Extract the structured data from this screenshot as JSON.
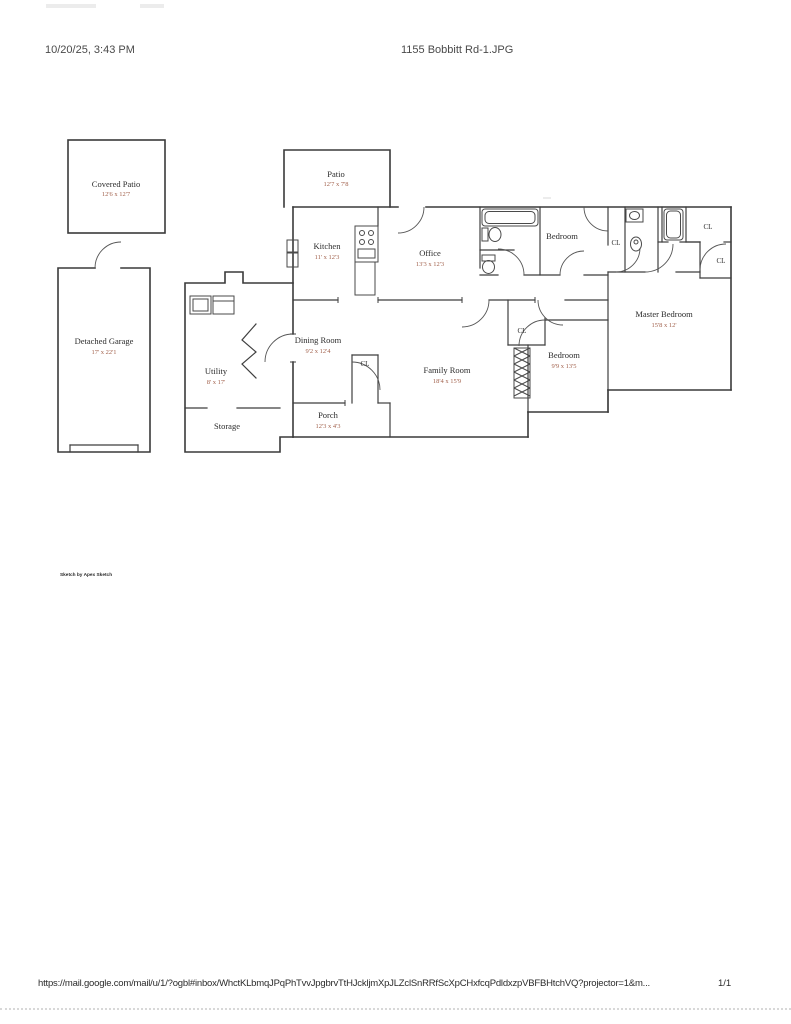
{
  "header": {
    "datetime": "10/20/25, 3:43 PM",
    "filename": "1155 Bobbitt Rd-1.JPG"
  },
  "footer": {
    "url": "https://mail.google.com/mail/u/1/?ogbl#inbox/WhctKLbmqJPqPhTvvJpgbrvTtHJckljmXpJLZclSnRRfScXpCHxfcqPdldxzpVBFBHtchVQ?projector=1&m...",
    "page_indicator": "1/1"
  },
  "credit": "Sketch by Apex Sketch",
  "floorplan": {
    "closet_label": "CL",
    "rooms": {
      "covered_patio": {
        "name": "Covered Patio",
        "dims": "12'6 x 12'7"
      },
      "patio": {
        "name": "Patio",
        "dims": "12'7 x 7'8"
      },
      "kitchen": {
        "name": "Kitchen",
        "dims": "11' x 12'3"
      },
      "office": {
        "name": "Office",
        "dims": "13'3 x 12'3"
      },
      "bedroom_top": {
        "name": "Bedroom",
        "dims": ""
      },
      "master_bedroom": {
        "name": "Master Bedroom",
        "dims": "15'8 x 12'"
      },
      "bedroom2": {
        "name": "Bedroom",
        "dims": "9'9 x 13'5"
      },
      "family_room": {
        "name": "Family Room",
        "dims": "18'4 x 15'9"
      },
      "dining_room": {
        "name": "Dining Room",
        "dims": "9'2 x 12'4"
      },
      "utility": {
        "name": "Utility",
        "dims": "8' x 17'"
      },
      "storage": {
        "name": "Storage",
        "dims": ""
      },
      "porch": {
        "name": "Porch",
        "dims": "12'3 x 4'3"
      },
      "detached_garage": {
        "name": "Detached Garage",
        "dims": "17' x 22'1"
      }
    }
  }
}
